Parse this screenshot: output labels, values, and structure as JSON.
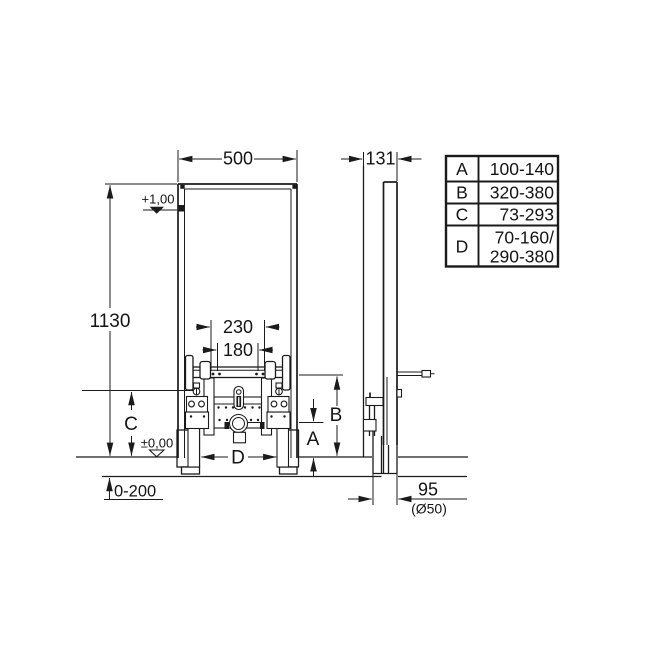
{
  "colors": {
    "line": "#1b1b1b",
    "background": "#ffffff"
  },
  "front_view": {
    "width": "500",
    "height": "1130",
    "level_top": "+1,00",
    "level_zero": "±0,00",
    "floor_buildup": "0-200",
    "bolt_spacing_outer": "230",
    "bolt_spacing_inner": "180",
    "dim_a": "A",
    "dim_b": "B",
    "dim_c": "C",
    "dim_d": "D"
  },
  "side_view": {
    "depth": "131",
    "drain_distance": "95",
    "drain_pipe": "(Ø50)"
  },
  "dimension_table": {
    "rows": [
      {
        "key": "A",
        "value": "100-140"
      },
      {
        "key": "B",
        "value": "320-380"
      },
      {
        "key": "C",
        "value": "73-293"
      },
      {
        "key": "D",
        "value_line1": "70-160/",
        "value_line2": "290-380"
      }
    ]
  }
}
